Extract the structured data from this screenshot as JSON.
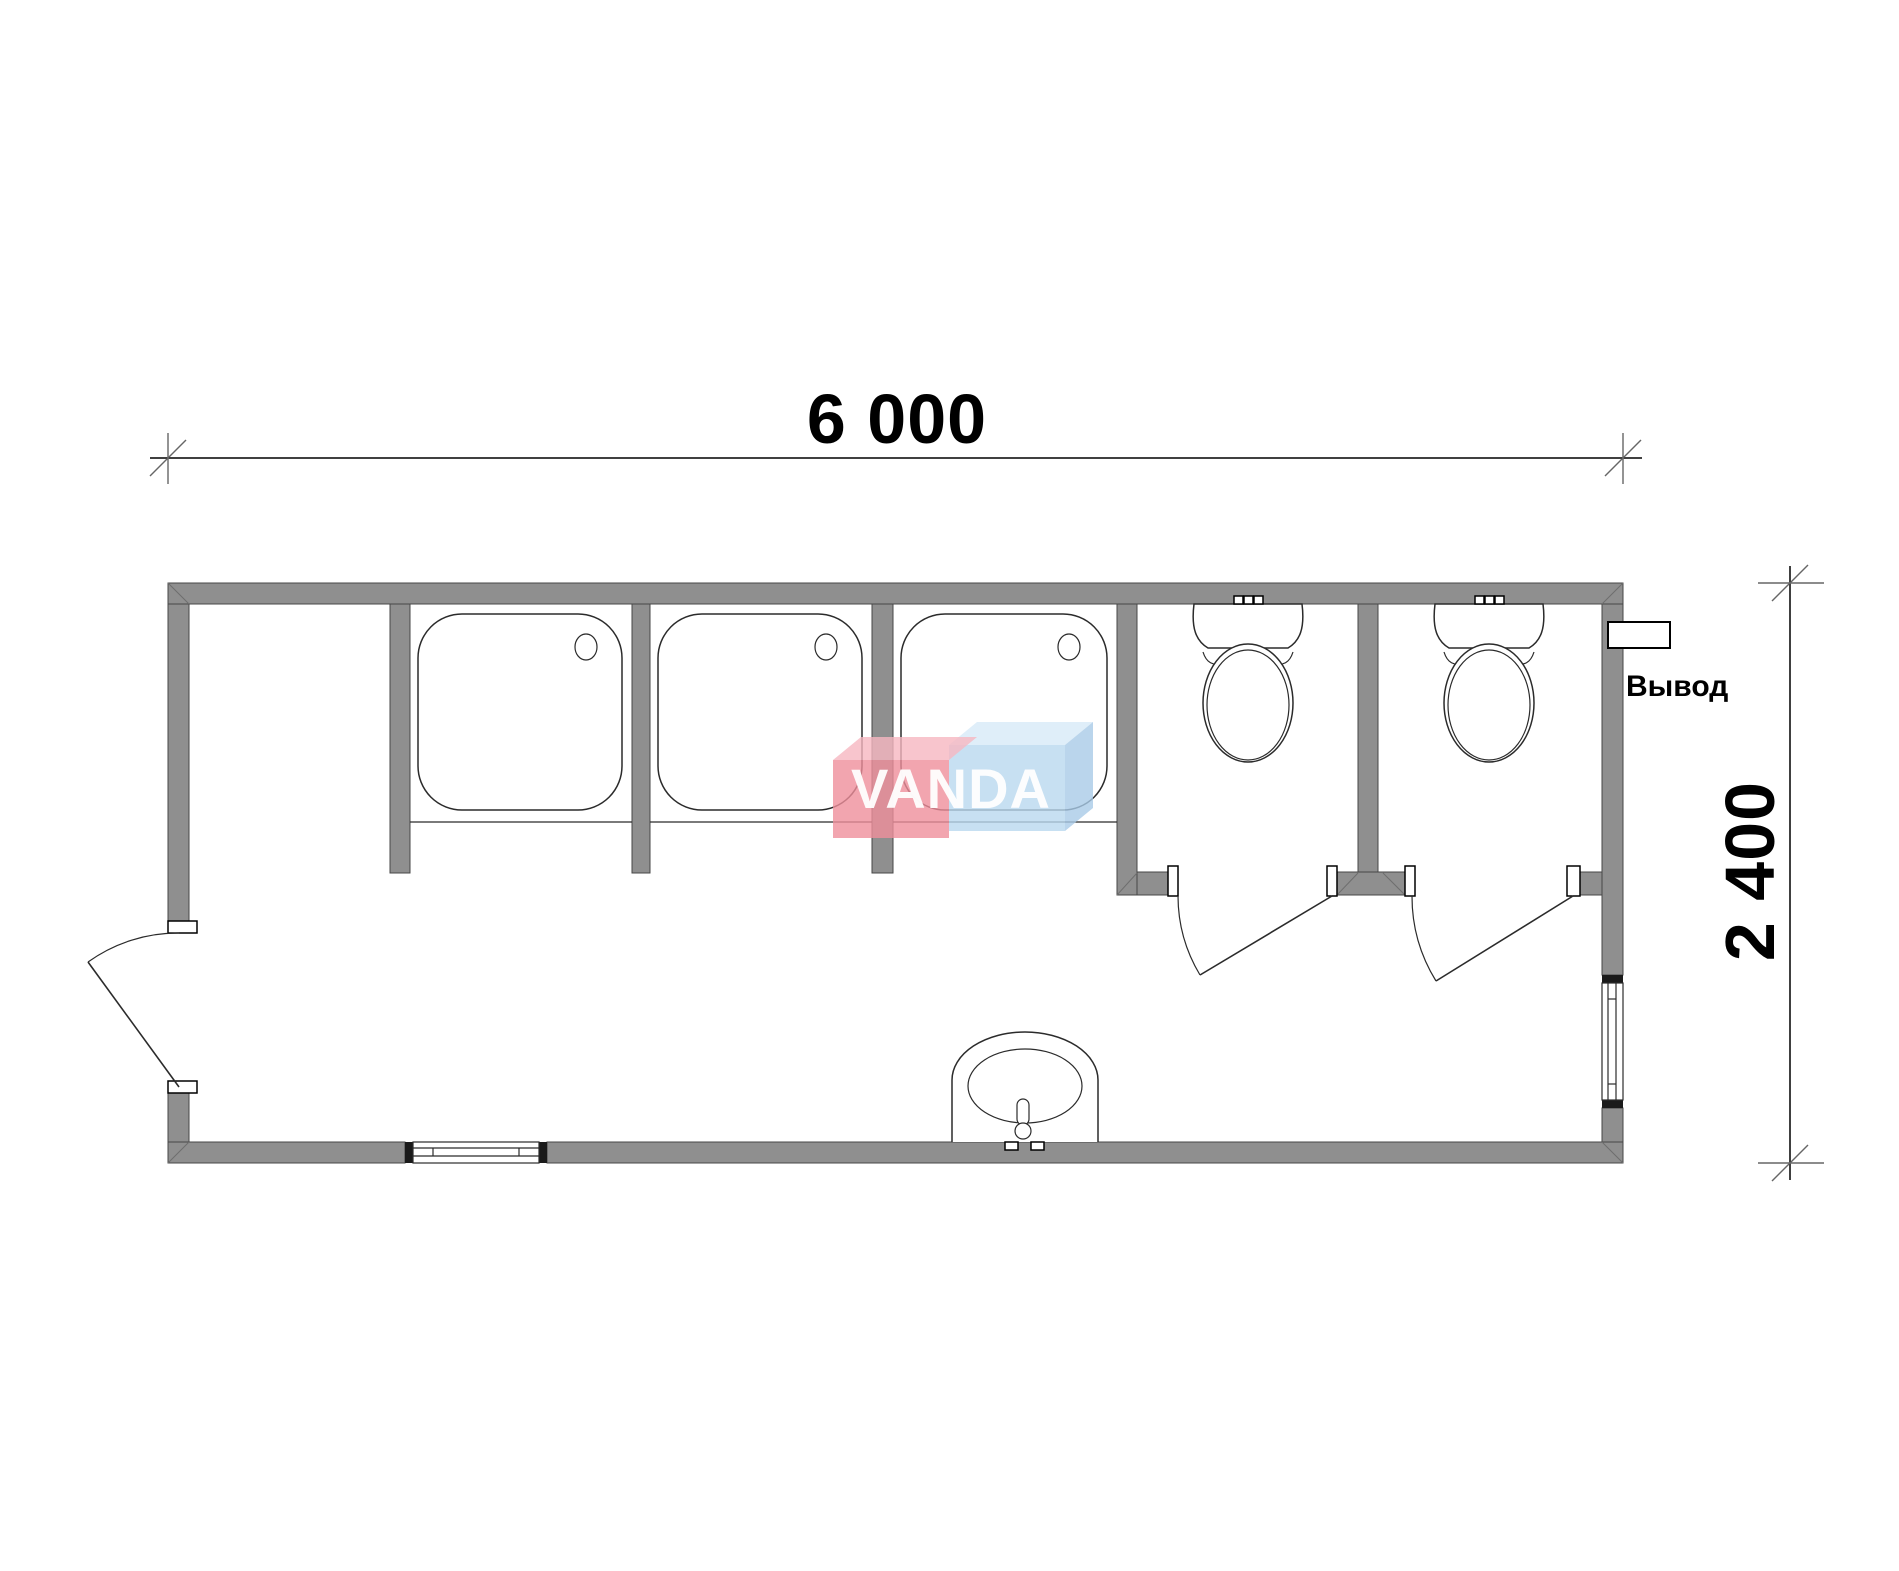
{
  "document": {
    "type": "floor-plan",
    "drawing": "sanitary container plan view"
  },
  "dimensions": {
    "width_label": "6 000",
    "height_label": "2 400"
  },
  "labels": {
    "outlet": "Вывод"
  },
  "logo": {
    "text": "VANDA"
  },
  "fixtures": [
    {
      "name": "shower-tray",
      "count": 3
    },
    {
      "name": "toilet",
      "count": 2
    },
    {
      "name": "washbasin",
      "count": 1
    },
    {
      "name": "window",
      "count": 2
    },
    {
      "name": "door",
      "count": 3
    },
    {
      "name": "pipe-outlet",
      "count": 1
    }
  ],
  "colors": {
    "bg": "#ffffff",
    "wall": "#8f8f8f",
    "wall_outline": "#474747",
    "line": "#2b2b2b",
    "dim_line": "#000000",
    "dim_tick": "#666666",
    "logo_red": "#ef8e9b",
    "logo_red_top": "#f6b7c0",
    "logo_blue": "#b9d8ef",
    "logo_blue_top": "#d7eaf8",
    "logo_blue_side": "#a9cbe7",
    "logo_text": "#ffffff"
  }
}
